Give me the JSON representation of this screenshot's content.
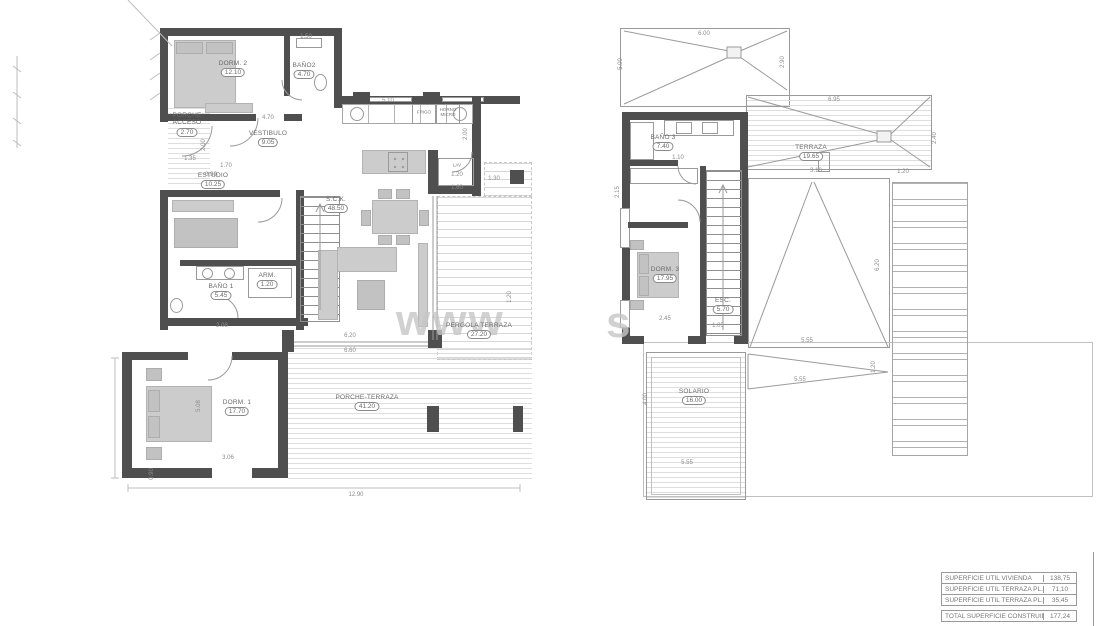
{
  "watermark": {
    "fragment_left": "www",
    "fragment_right": "s"
  },
  "plans": {
    "ground": {
      "rooms": [
        {
          "label": "DORM. 2",
          "area": "12.10"
        },
        {
          "label": "BAÑO2",
          "area": "4.70"
        },
        {
          "label": "VESTIBULO",
          "area": "9.05"
        },
        {
          "label": "PORCHE\nACCESO",
          "area": "2.70"
        },
        {
          "label": "ESTUDIO",
          "area": "10.25"
        },
        {
          "label": "S.C.K.",
          "area": "48.50"
        },
        {
          "label": "BAÑO 1",
          "area": "5.45"
        },
        {
          "label": "ARM.",
          "area": "1.20"
        },
        {
          "label": "DORM. 1",
          "area": "17.70"
        },
        {
          "label": "PORCHE-TERRAZA",
          "area": "41.20"
        },
        {
          "label": "PERGOLA TERRAZA",
          "area": "27.20"
        }
      ],
      "dims": [
        "1.50",
        "4.70",
        "5.10",
        "2.00",
        "1.20",
        "1.30",
        "1.60",
        "1.35",
        "1.70",
        "0.90",
        "2.00",
        "2.08",
        "6.20",
        "6.60",
        "3.06",
        "12.90",
        "0.90",
        "5.08",
        "1.20"
      ]
    },
    "upper": {
      "rooms": [
        {
          "label": "BAÑO 3",
          "area": "7.40"
        },
        {
          "label": "TERRAZA",
          "area": "19.65"
        },
        {
          "label": "DORM. 3",
          "area": "17.95"
        },
        {
          "label": "ESC.",
          "area": "5.70"
        },
        {
          "label": "SOLARIO",
          "area": "16.00"
        }
      ],
      "dims": [
        "6.00",
        "5.00",
        "2.90",
        "6.95",
        "2.40",
        "1.10",
        "3.10",
        "1.20",
        "6.20",
        "5.55",
        "5.55",
        "1.20",
        "2.45",
        "1.05",
        "4.00",
        "5.55",
        "2.15"
      ]
    }
  },
  "kitchen_labels": {
    "fridge": "FRIGO",
    "oven": "HORNO\nMICRO",
    "laundry": "LAV"
  },
  "area_table": {
    "rows": [
      {
        "label": "SUPERFICIE ÚTIL VIVIENDA",
        "value": "138,75"
      },
      {
        "label": "SUPERFICIE ÚTIL TERRAZA PL. BAJA",
        "value": "71,10"
      },
      {
        "label": "SUPERFICIE ÚTIL TERRAZA PL. ALTA",
        "value": "35,45"
      }
    ],
    "total": {
      "label": "TOTAL SUPERFICIE CONSTRUIDA",
      "value": "177,24"
    }
  },
  "colors": {
    "wall": "#4f4f4f",
    "line": "#9a9a9a",
    "furniture": "#cccccc",
    "hatch": "#dedede",
    "text": "#6a6a6a",
    "watermark": "#c6c6c6"
  }
}
